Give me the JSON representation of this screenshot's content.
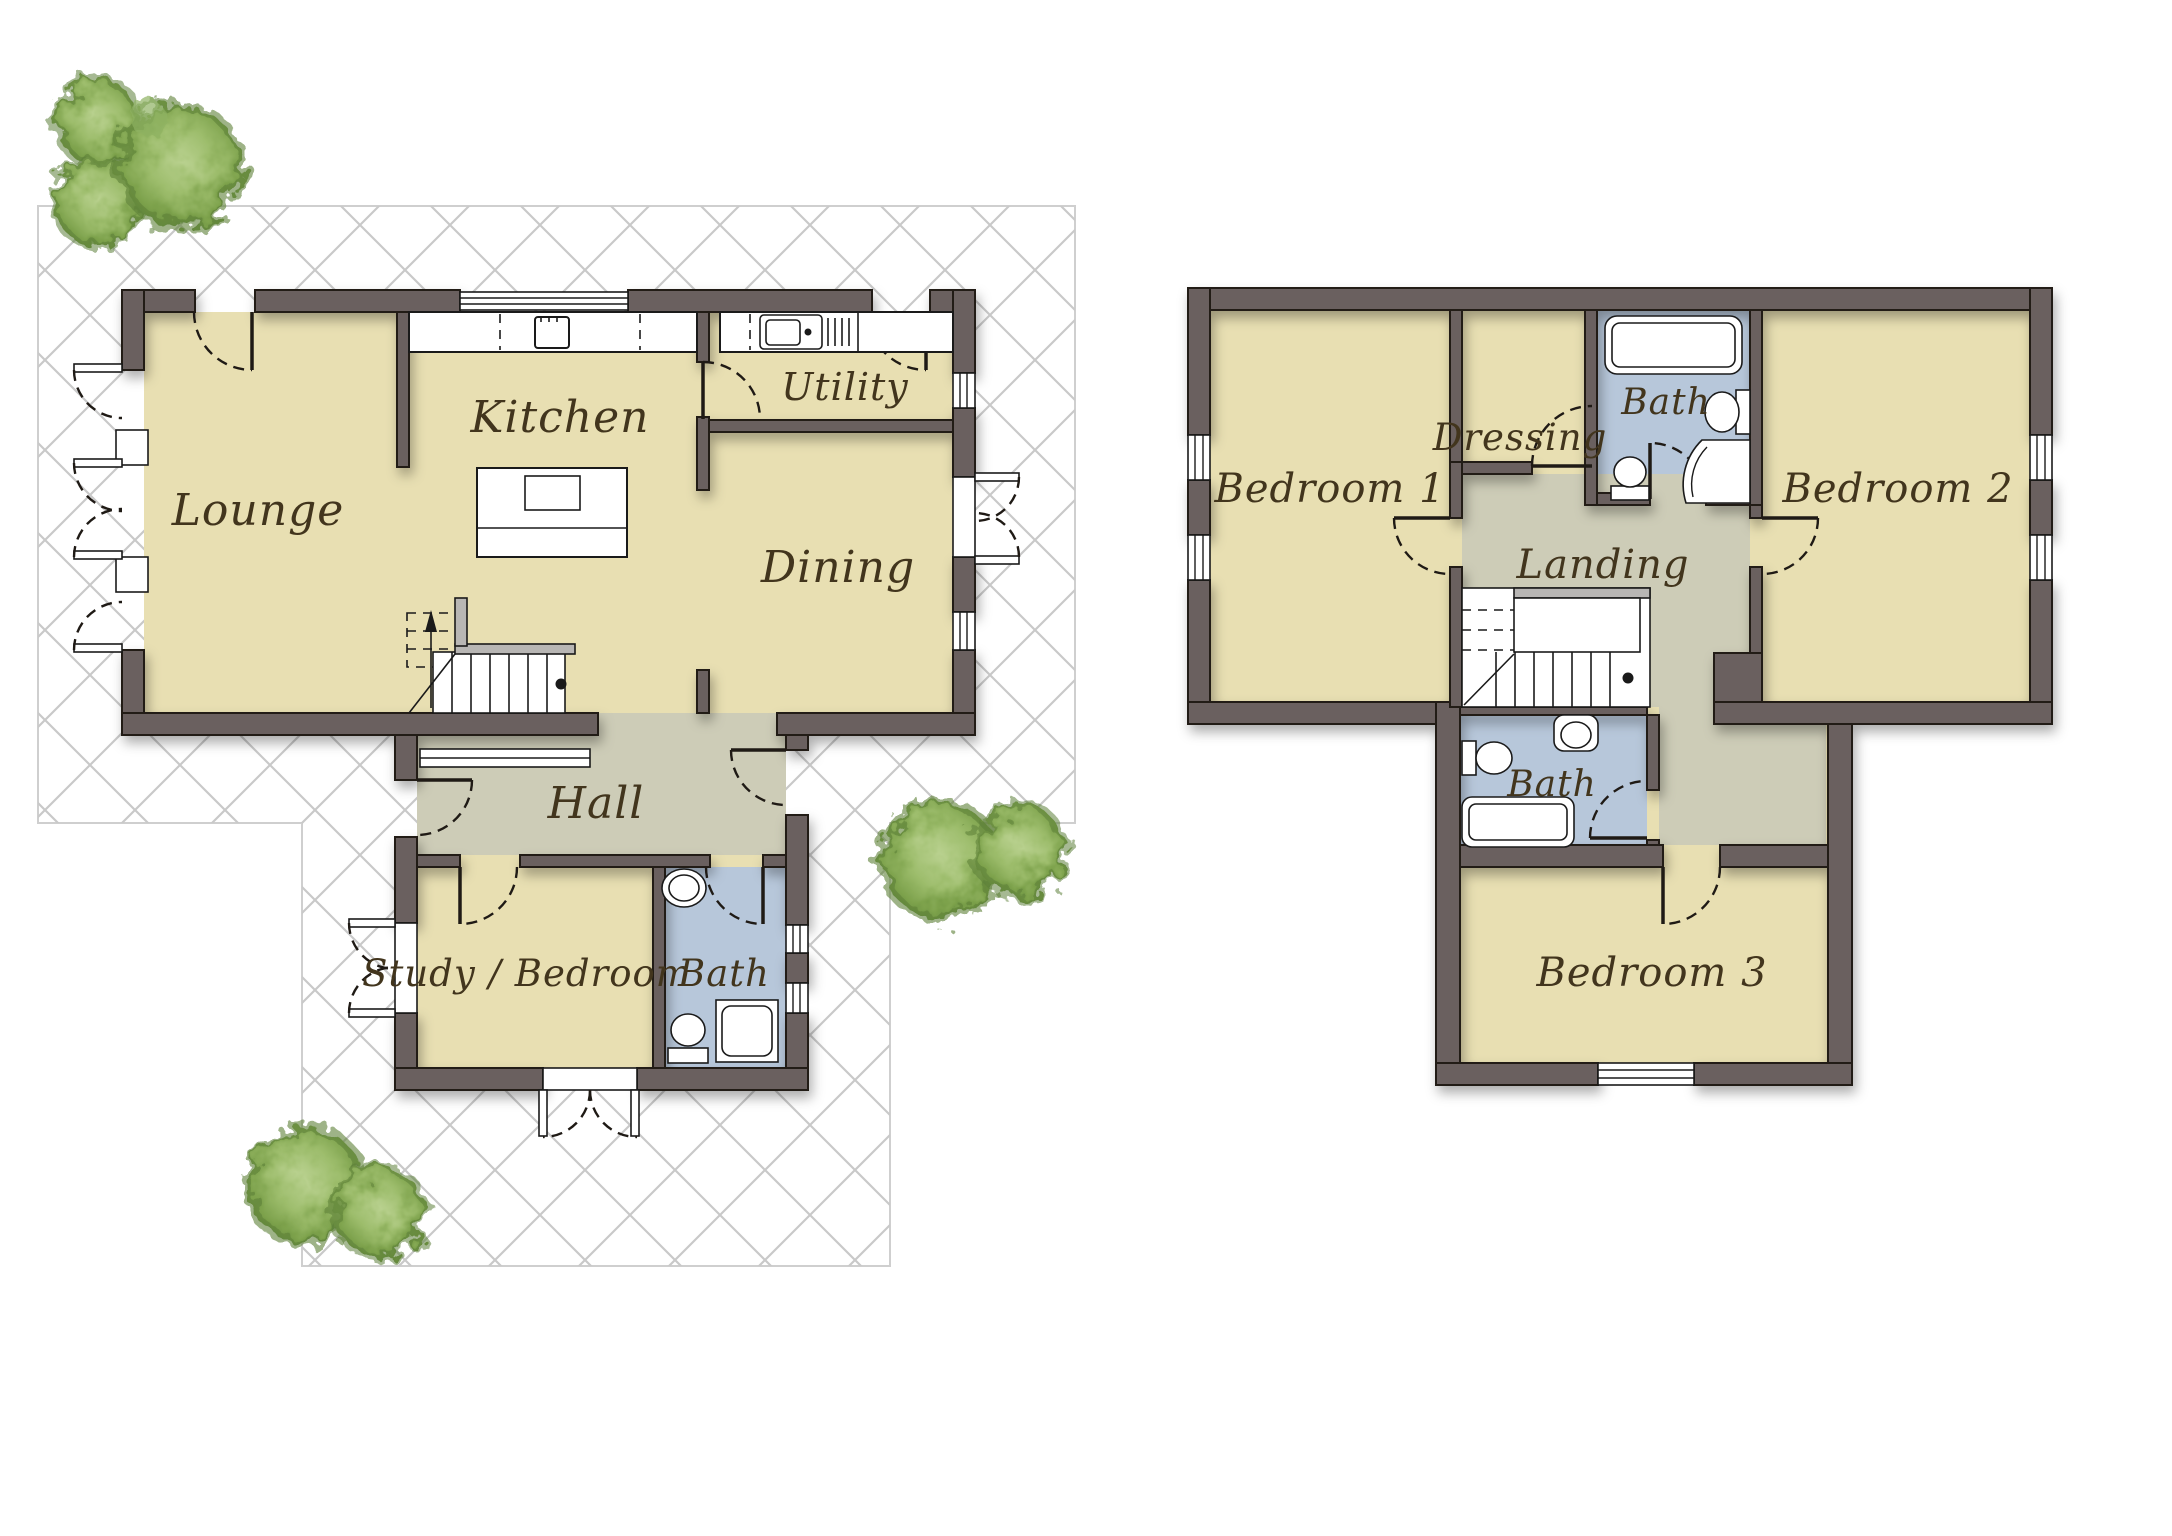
{
  "plan": {
    "type": "residential-floor-plan",
    "colors": {
      "wall": "#6a615e",
      "wall_outline": "#241e19",
      "floor_rooms": "#e8dfb2",
      "floor_hall_landing": "#cdccb7",
      "floor_bathrooms": "#b7c7da",
      "patio_hatch_line": "#c9c9c9",
      "label_text": "#42351d",
      "tree_dark": "#648b3c",
      "tree_mid": "#8fb262",
      "tree_light": "#b9d18f"
    },
    "ground_floor": {
      "rooms": [
        {
          "id": "lounge",
          "label": "Lounge"
        },
        {
          "id": "kitchen",
          "label": "Kitchen"
        },
        {
          "id": "utility",
          "label": "Utility"
        },
        {
          "id": "dining",
          "label": "Dining"
        },
        {
          "id": "hall",
          "label": "Hall"
        },
        {
          "id": "study-bedroom",
          "label": "Study / Bedroom"
        },
        {
          "id": "bath",
          "label": "Bath"
        }
      ],
      "fixtures": [
        "kitchen-counter",
        "hob-icon",
        "kitchen-island",
        "utility-sink-icon",
        "stairs-up-icon",
        "basin-icon",
        "toilet-icon",
        "shower-icon",
        "french-doors-icon",
        "door-swing-icon",
        "window-icon",
        "hall-screen"
      ]
    },
    "first_floor": {
      "rooms": [
        {
          "id": "bedroom-1",
          "label": "Bedroom 1"
        },
        {
          "id": "dressing",
          "label": "Dressing"
        },
        {
          "id": "bath-ensuite",
          "label": "Bath"
        },
        {
          "id": "bedroom-2",
          "label": "Bedroom 2"
        },
        {
          "id": "landing",
          "label": "Landing"
        },
        {
          "id": "bath-family",
          "label": "Bath"
        },
        {
          "id": "bedroom-3",
          "label": "Bedroom 3"
        }
      ],
      "fixtures": [
        "stairs-icon",
        "bathtub-icon",
        "basin-icon",
        "toilet-icon",
        "quadrant-shower-icon",
        "door-swing-icon",
        "window-icon"
      ]
    },
    "landscape": {
      "patio": "cross-hatch-paving",
      "trees": [
        "tree-cluster-top-left",
        "tree-cluster-middle-right",
        "tree-cluster-bottom-left"
      ]
    }
  }
}
